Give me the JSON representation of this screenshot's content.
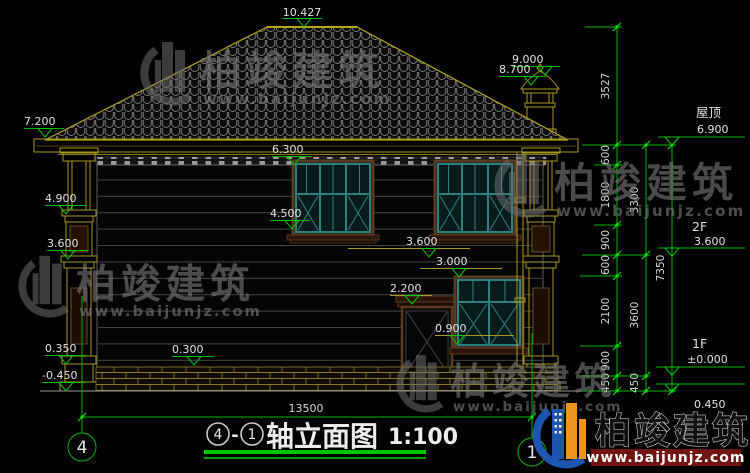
{
  "watermark": {
    "company": "柏竣建筑",
    "website": "www.baijunjz.com"
  },
  "brand": {
    "company": "柏竣建筑",
    "website": "www.baijunjz.com"
  },
  "levels": {
    "ridge": "10.427",
    "eave": "7.200",
    "chimney_top": "9.000",
    "chimney_cap": "8.700",
    "win2_head": "6.300",
    "win2_sill": "4.500",
    "col_ring": "4.900",
    "col_belt": "3.600",
    "belt": "3.600",
    "win1_head": "3.000",
    "door_head": "2.200",
    "win1_sill": "0.900",
    "plinth": "0.350",
    "base": "0.300",
    "ground": "-0.450"
  },
  "floors": {
    "roof_label": "屋顶",
    "roof_elev": "6.900",
    "f2_label": "2F",
    "f2_elev": "3.600",
    "f1_label": "1F",
    "f1_elev": "±0.000",
    "below_elev": "0.450"
  },
  "dims": {
    "total_width": "13500",
    "chain_a": [
      "3527",
      "600",
      "1800",
      "900",
      "600",
      "2100",
      "900",
      "450"
    ],
    "chain_b": [
      "3300",
      "3600",
      "450"
    ],
    "chain_c": [
      "7350"
    ]
  },
  "axes": {
    "left": "4",
    "right": "1"
  },
  "title": {
    "bubble_left": "4",
    "dash": "-",
    "bubble_right": "1",
    "name": "轴立面图",
    "scale": "1:100"
  },
  "colors": {
    "dim_green": "#00b400",
    "outline_olive": "#a8981c",
    "window_teal": "#2e8080",
    "brand_blue": "#1e55b0",
    "brand_orange": "#f0921e",
    "brand_red": "#701414"
  }
}
